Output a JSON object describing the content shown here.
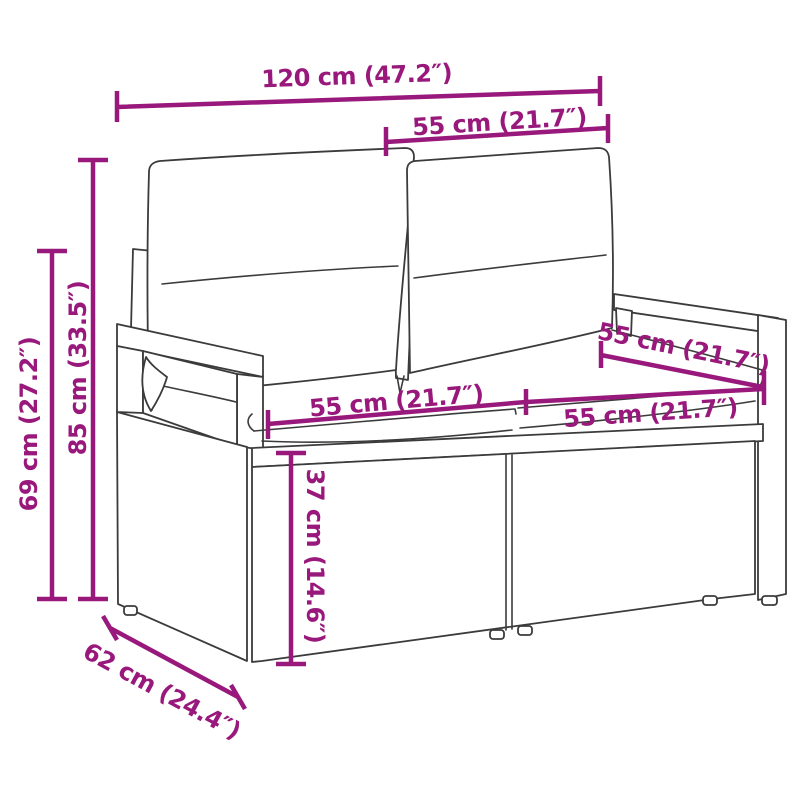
{
  "figure": {
    "type": "product-dimension-diagram",
    "subject": "poly rattan 2-seater garden bench with back and seat cushions"
  },
  "colors": {
    "dimension_accent": "#99187C",
    "line_art": "#3B3B3B",
    "background": "#FFFFFF"
  },
  "measurements": {
    "total_width": "120 cm (47.2″)",
    "backrest_width": "55 cm (21.7″)",
    "total_height": "85 cm (33.5″)",
    "armrest_height": "69 cm (27.2″)",
    "seat_depth": "55 cm (21.7″)",
    "seat_width_left": "55 cm (21.7″)",
    "seat_width_right": "55 cm (21.7″)",
    "seat_height": "37 cm (14.6″)",
    "base_depth": "62 cm (24.4″)"
  }
}
